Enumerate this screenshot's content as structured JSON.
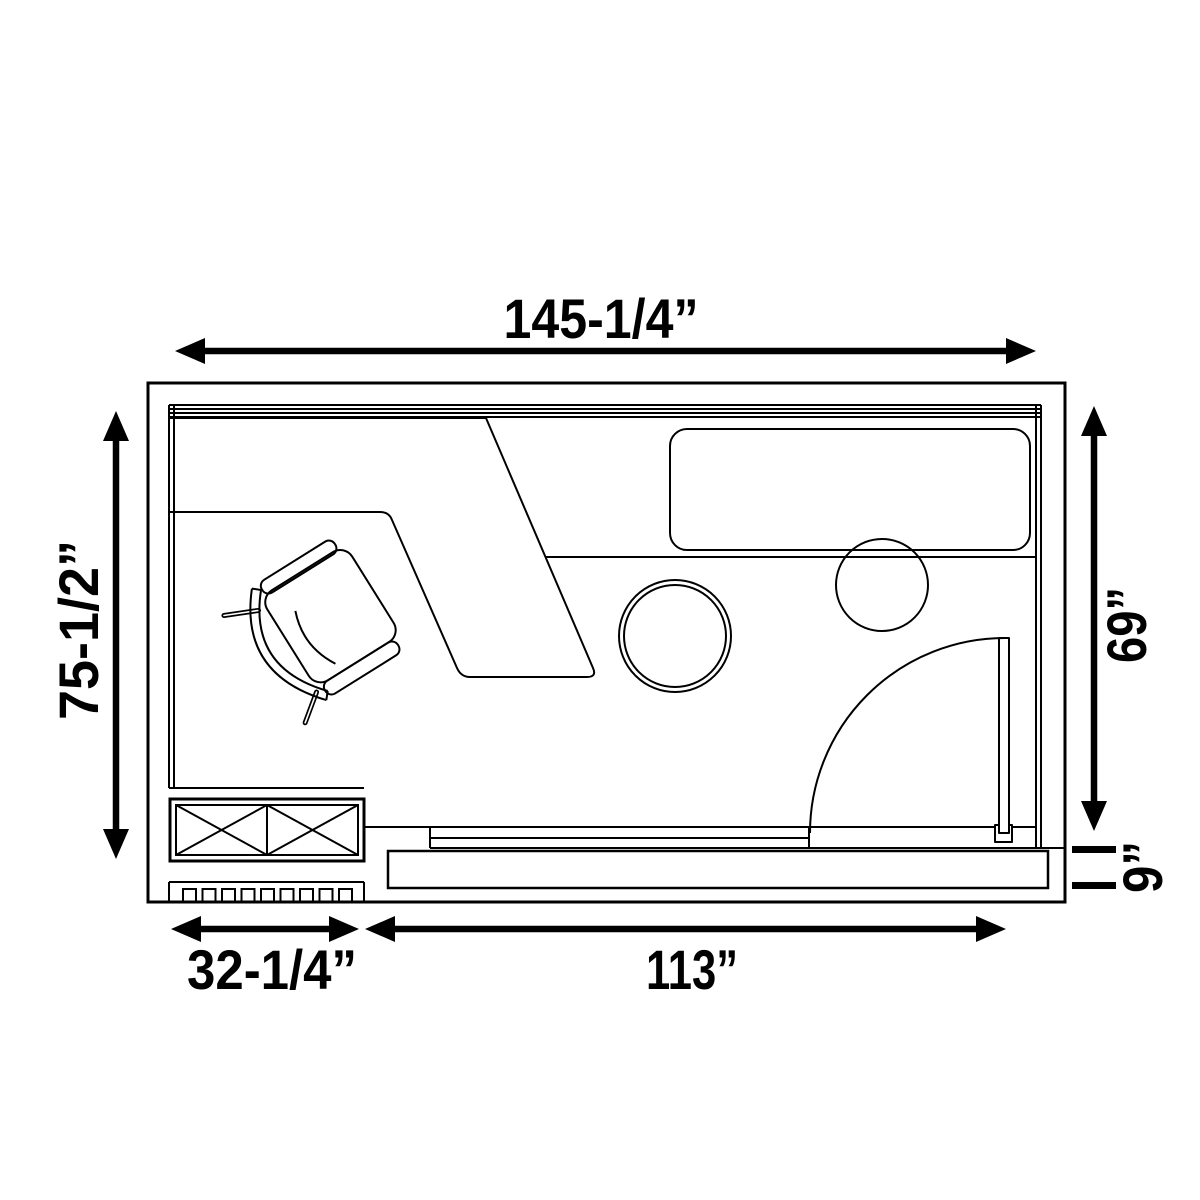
{
  "plan": {
    "background_color": "#ffffff",
    "line_color": "#000000",
    "dimensions": {
      "top_width": "145-1/4”",
      "left_height": "75-1/2”",
      "right_height": "69”",
      "deck_depth": "9”",
      "bottom_left_width": "32-1/4”",
      "bottom_right_width": "113”"
    },
    "furniture_icons": [
      "window-wall-icon",
      "angled-desk-icon",
      "office-chair-icon",
      "counter-edge-icon",
      "daybed-cushion-icon",
      "round-stool-icon",
      "round-table-icon",
      "swing-door-icon",
      "storage-cabinet-icon",
      "vent-grille-icon",
      "deck-step-icon"
    ]
  }
}
